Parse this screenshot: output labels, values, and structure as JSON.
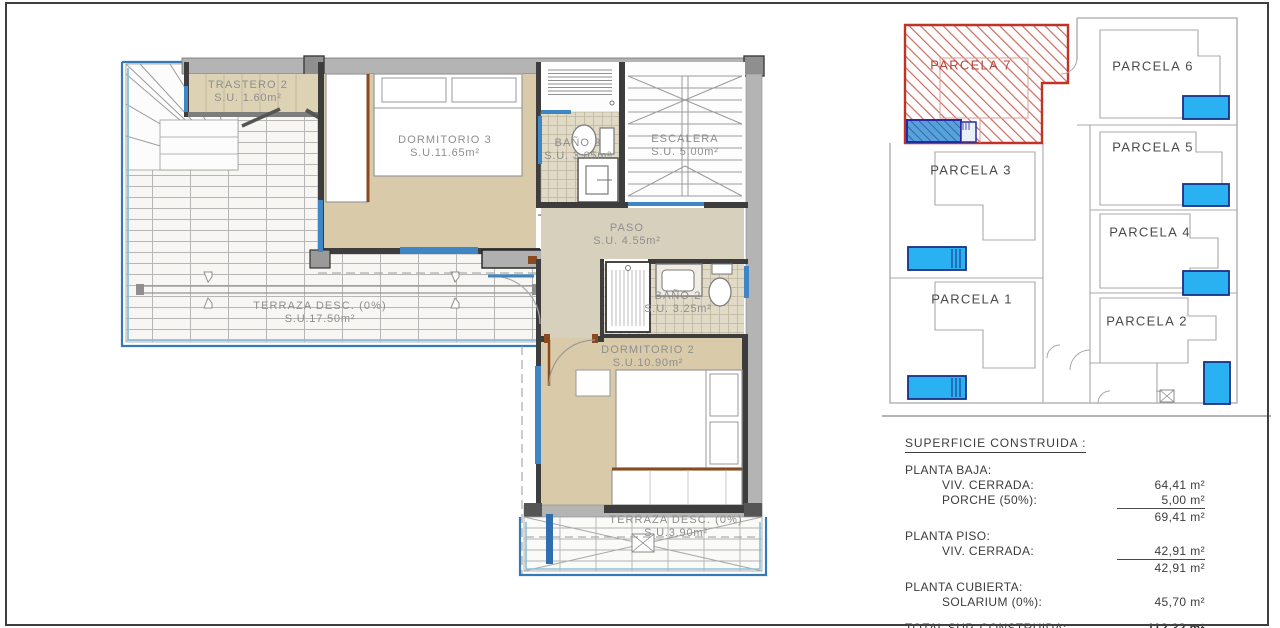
{
  "floor_plan": {
    "rooms": [
      {
        "id": "trastero-2",
        "name": "TRASTERO 2",
        "area": "S.U. 1.60m²"
      },
      {
        "id": "dormitorio-3",
        "name": "DORMITORIO 3",
        "area": "S.U.11.65m²"
      },
      {
        "id": "bano-3",
        "name": "BAÑO 3",
        "area": "S.U. 3.65m²"
      },
      {
        "id": "escalera",
        "name": "ESCALERA",
        "area": "S.U. 5.00m²"
      },
      {
        "id": "paso",
        "name": "PASO",
        "area": "S.U. 4.55m²"
      },
      {
        "id": "bano-2",
        "name": "BAÑO 2",
        "area": "S.U. 3.25m²"
      },
      {
        "id": "dormitorio-2",
        "name": "DORMITORIO 2",
        "area": "S.U.10.90m²"
      },
      {
        "id": "terraza-grande",
        "name": "TERRAZA DESC. (0%)",
        "area": "S.U.17.50m²"
      },
      {
        "id": "terraza-inferior",
        "name": "TERRAZA DESC. (0%)",
        "area": "S.U.3.90m²"
      }
    ]
  },
  "site_plan": {
    "parcels": [
      {
        "label": "PARCELA 7",
        "highlighted": true
      },
      {
        "label": "PARCELA 6",
        "highlighted": false
      },
      {
        "label": "PARCELA 5",
        "highlighted": false
      },
      {
        "label": "PARCELA 4",
        "highlighted": false
      },
      {
        "label": "PARCELA 3",
        "highlighted": false
      },
      {
        "label": "PARCELA 2",
        "highlighted": false
      },
      {
        "label": "PARCELA 1",
        "highlighted": false
      }
    ]
  },
  "summary_table": {
    "title": "SUPERFICIE CONSTRUIDA :",
    "rows": [
      {
        "label": "PLANTA BAJA:",
        "value": ""
      },
      {
        "label": "VIV. CERRADA:",
        "value": "64,41 m²"
      },
      {
        "label": "PORCHE (50%):",
        "value": "5,00 m²"
      },
      {
        "label": "",
        "value": "69,41 m²"
      },
      {
        "label": "PLANTA PISO:",
        "value": ""
      },
      {
        "label": "VIV. CERRADA:",
        "value": "42,91 m²"
      },
      {
        "label": "",
        "value": "42,91 m²"
      },
      {
        "label": "PLANTA CUBIERTA:",
        "value": ""
      },
      {
        "label": "SOLARIUM (0%):",
        "value": "45,70 m²"
      },
      {
        "label": "TOTAL SUP. CONSTRUIDA:",
        "value": "112,32 m²"
      }
    ]
  },
  "colors": {
    "floor_beige": "#d9cbaa",
    "wall_dark": "#3d3d3d",
    "wall_gray": "#b4b4b4",
    "window_blue": "#3f86c5",
    "terrace_border_blue": "#3579b8",
    "parcel_highlight_red": "#c23327",
    "footprint_blue": "#2a2a9e",
    "pool_blue": "#29b1f2",
    "label_gray": "#8e8e8e",
    "text_dark": "#3c3c3c"
  }
}
